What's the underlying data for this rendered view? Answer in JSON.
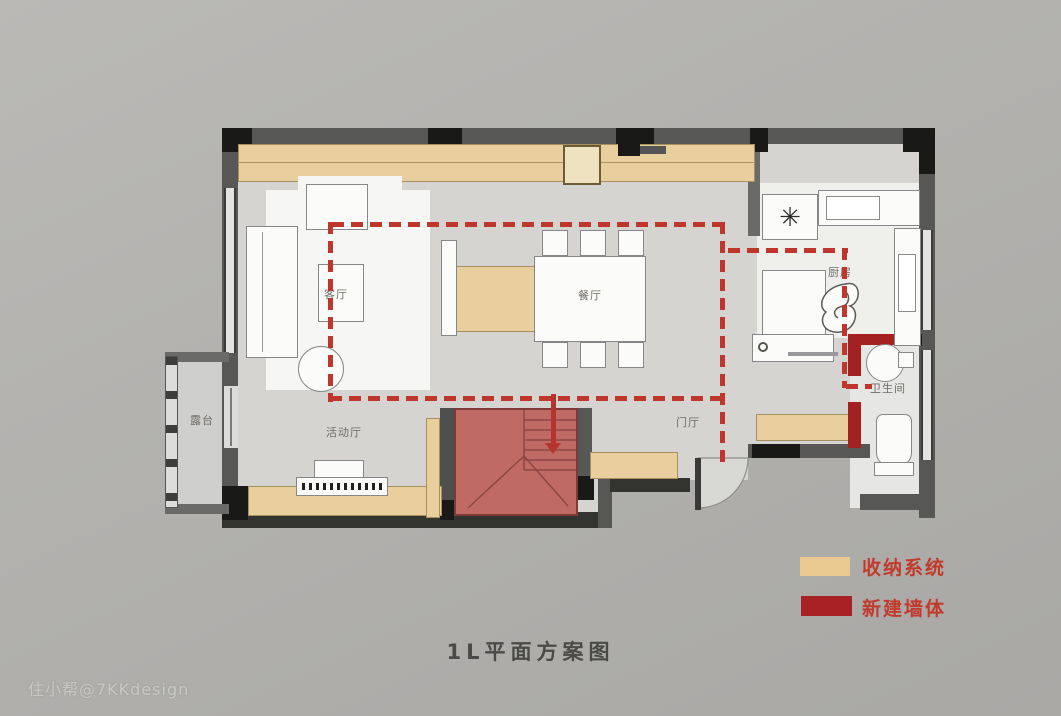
{
  "canvas": {
    "background": "#b2b1ae"
  },
  "title": {
    "text": "1L平面方案图"
  },
  "watermark": {
    "text": "住小帮@7KKdesign"
  },
  "legend": {
    "items": [
      {
        "label": "收纳系统",
        "color": "#e9c98f"
      },
      {
        "label": "新建墙体",
        "color": "#a82124"
      }
    ]
  },
  "rooms": {
    "living": {
      "label": "客厅"
    },
    "dining": {
      "label": "餐厅"
    },
    "kitchen": {
      "label": "厨房"
    },
    "bathroom": {
      "label": "卫生间"
    },
    "activity": {
      "label": "活动厅"
    },
    "foyer": {
      "label": "门厅"
    },
    "terrace": {
      "label": "露台"
    }
  },
  "symbols": {
    "stove_burner": "✳"
  },
  "colors": {
    "wall": "#575755",
    "floor": "#d5d4d1",
    "storage_cabinet": "#e9cf9e",
    "new_wall": "#a32120",
    "stairs_overlay": "#c06a66",
    "route_dashed": "#bf372c"
  }
}
